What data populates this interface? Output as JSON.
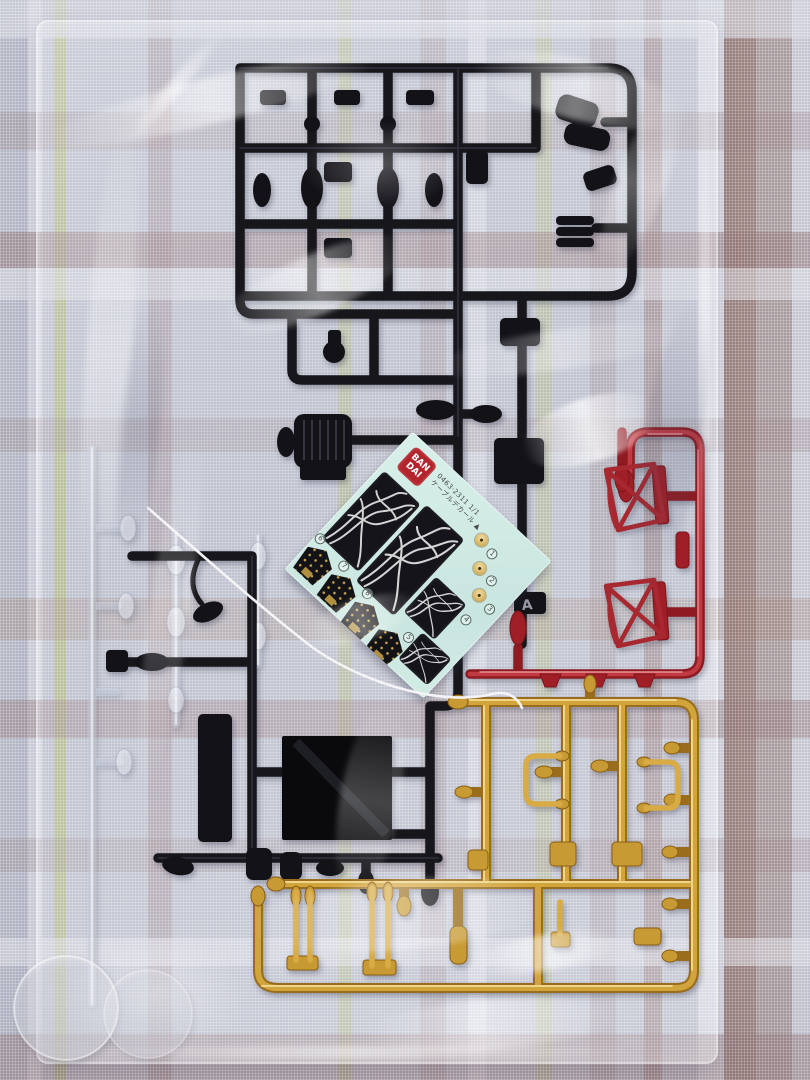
{
  "scene": {
    "description": "Photograph of plastic scale-model kit runners (sprues) sealed inside a clear plastic bag, lying on a plaid woven fabric",
    "background": "plaid fabric in pale blue-grey with mauve, brown, white and yellow-green stripes"
  },
  "decal_sheet": {
    "logo_line1": "BAN",
    "logo_line2": "DAI",
    "code_text": "0463·2311 1/1",
    "label_text": "ケーブルデカール ▲",
    "markers": [
      "1",
      "2",
      "3",
      "4",
      "5",
      "6",
      "7",
      "8"
    ],
    "backing_color": "#d2ebe5",
    "logo_color": "#b3242c"
  },
  "sprues": {
    "black": {
      "name": "black runner",
      "color": "#17171b",
      "gate_tag": "A"
    },
    "red": {
      "name": "red runner",
      "color": "#a01e26"
    },
    "gold": {
      "name": "gold plated runner",
      "color": "#c79a33"
    },
    "clear": {
      "name": "clear runner",
      "color": "#eef1f8"
    }
  },
  "colors": {
    "fabric_base": "#c2c5d1",
    "fabric_mauve": "#957474",
    "fabric_brown": "#906a60",
    "fabric_green": "#b7be78",
    "bag_highlight": "#ffffff",
    "decal_gold_dot": "#c9a44c"
  }
}
